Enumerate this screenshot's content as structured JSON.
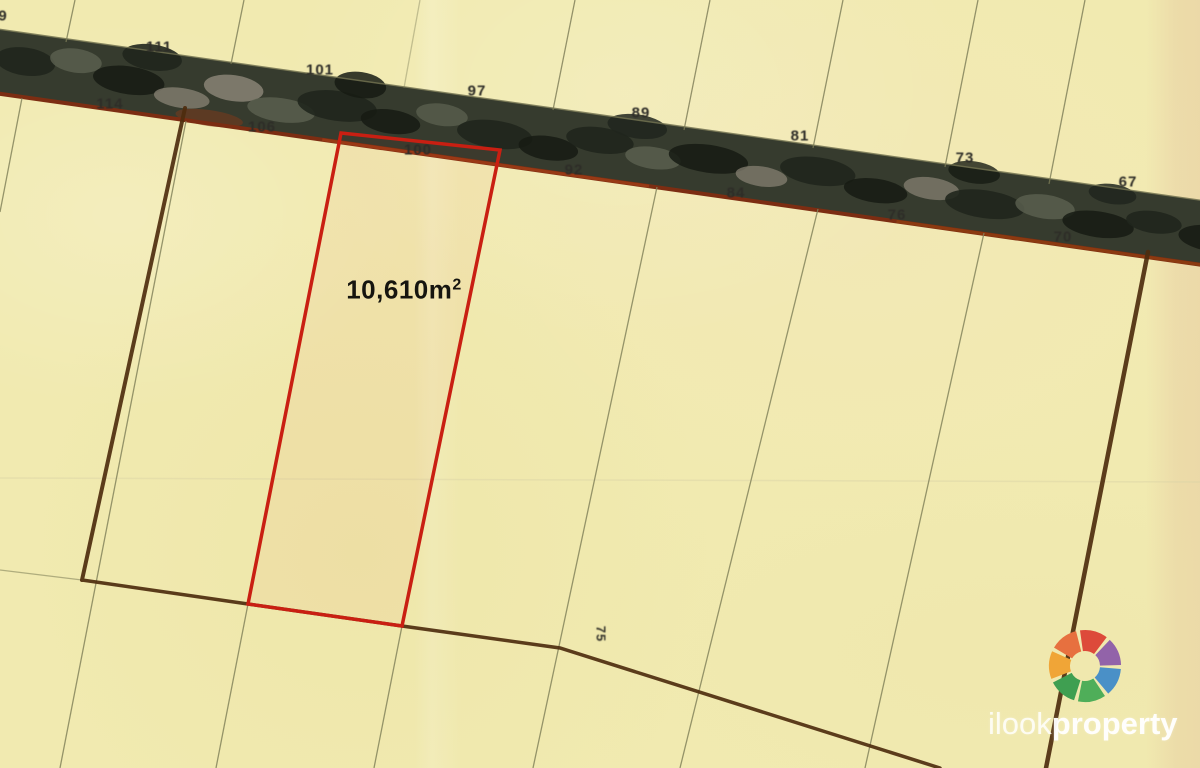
{
  "map": {
    "parcel_area": {
      "value": "10,610m",
      "sup": "2",
      "x": 404,
      "y": 290
    },
    "rotated_lot_label": {
      "text": "75",
      "x": 601,
      "y": 634,
      "rotation": 90
    },
    "edge_partial_label": {
      "text": "9",
      "x": 3,
      "y": 16
    },
    "upper_road_lot_numbers": [
      {
        "text": "111",
        "x": 159,
        "y": 47
      },
      {
        "text": "101",
        "x": 320,
        "y": 70
      },
      {
        "text": "97",
        "x": 477,
        "y": 91
      },
      {
        "text": "89",
        "x": 641,
        "y": 113
      },
      {
        "text": "81",
        "x": 800,
        "y": 136
      },
      {
        "text": "73",
        "x": 965,
        "y": 158
      },
      {
        "text": "67",
        "x": 1128,
        "y": 182
      }
    ],
    "lower_road_lot_numbers": [
      {
        "text": "114",
        "x": 110,
        "y": 104
      },
      {
        "text": "106",
        "x": 262,
        "y": 127
      },
      {
        "text": "100",
        "x": 418,
        "y": 150
      },
      {
        "text": "92",
        "x": 574,
        "y": 170
      },
      {
        "text": "84",
        "x": 736,
        "y": 193
      },
      {
        "text": "76",
        "x": 897,
        "y": 215
      },
      {
        "text": "70",
        "x": 1063,
        "y": 237
      }
    ]
  },
  "watermark": {
    "brand_light": "ilook",
    "brand_bold": "property",
    "logo_colors": [
      "#dd4a3a",
      "#9263a9",
      "#4a90c7",
      "#4fae59",
      "#3f9f51",
      "#f0a537",
      "#e7703f"
    ]
  },
  "colors": {
    "background": "#f1eab0",
    "highlight_red": "#c91f12",
    "boundary_brown": "#4e2c0e",
    "road_dark": "#363b2e",
    "road_edge_rust": "#7c2d12",
    "lot_line_olive": "#84845c"
  }
}
